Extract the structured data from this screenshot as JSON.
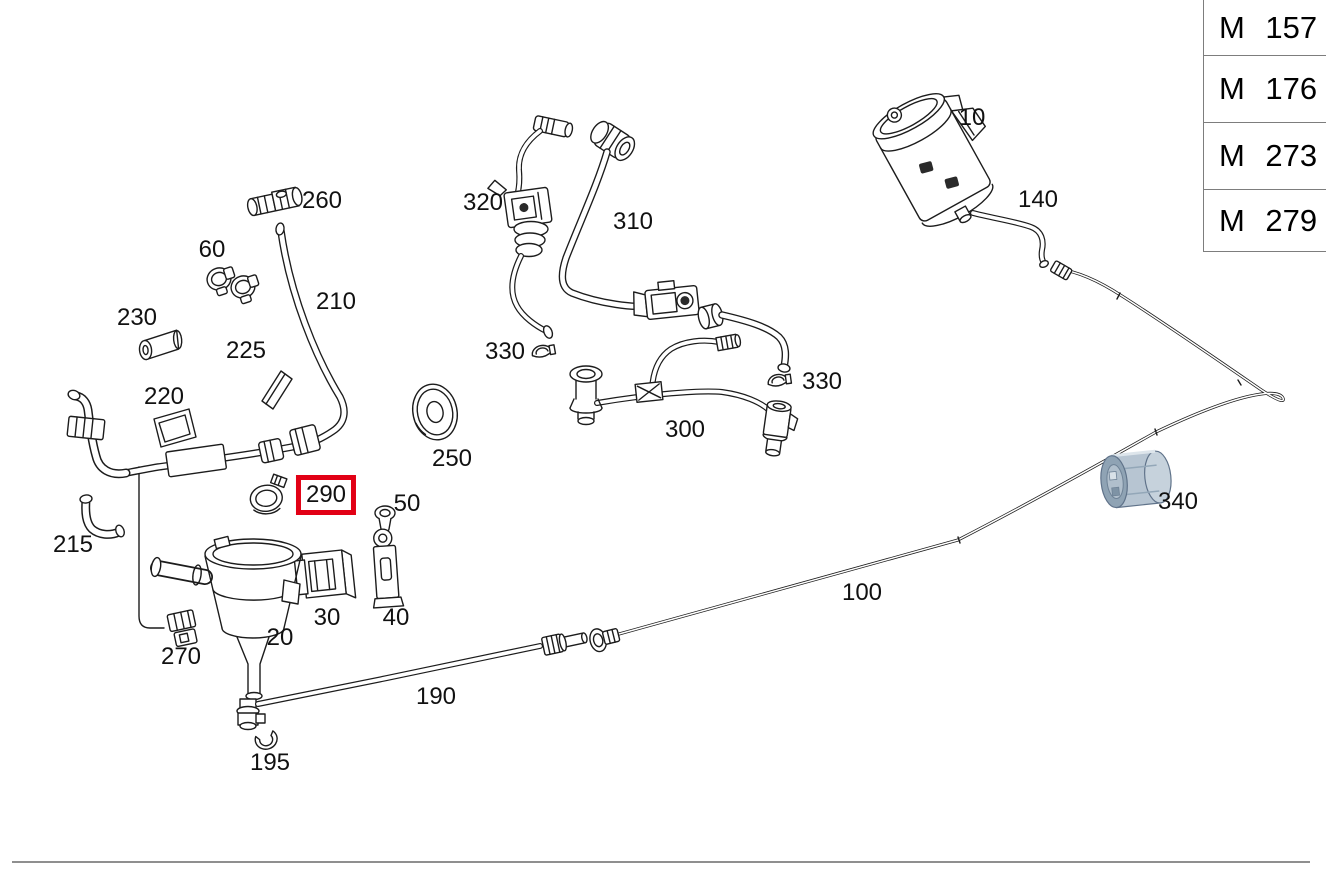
{
  "diagram": {
    "parts": [
      {
        "num": "260"
      },
      {
        "num": "60"
      },
      {
        "num": "230"
      },
      {
        "num": "225"
      },
      {
        "num": "220"
      },
      {
        "num": "210"
      },
      {
        "num": "215"
      },
      {
        "num": "290"
      },
      {
        "num": "50"
      },
      {
        "num": "250"
      },
      {
        "num": "320"
      },
      {
        "num": "330"
      },
      {
        "num": "310"
      },
      {
        "num": "300"
      },
      {
        "num": "330"
      },
      {
        "num": "10"
      },
      {
        "num": "140"
      },
      {
        "num": "340"
      },
      {
        "num": "100"
      },
      {
        "num": "190"
      },
      {
        "num": "195"
      },
      {
        "num": "270"
      },
      {
        "num": "20"
      },
      {
        "num": "30"
      },
      {
        "num": "40"
      }
    ],
    "highlighted_part": "290",
    "colors": {
      "line": "#1c1c1c",
      "highlight_box": "#e20015",
      "part_340_body": "#b7c5d2",
      "part_340_cap": "#c6d2dc",
      "part_340_opening": "#8fa3b4",
      "table_border": "#7d7d7d"
    }
  },
  "engine_table": {
    "rows": [
      {
        "code": "M 157"
      },
      {
        "code": "M 176"
      },
      {
        "code": "M 273"
      },
      {
        "code": "M 279"
      }
    ]
  }
}
